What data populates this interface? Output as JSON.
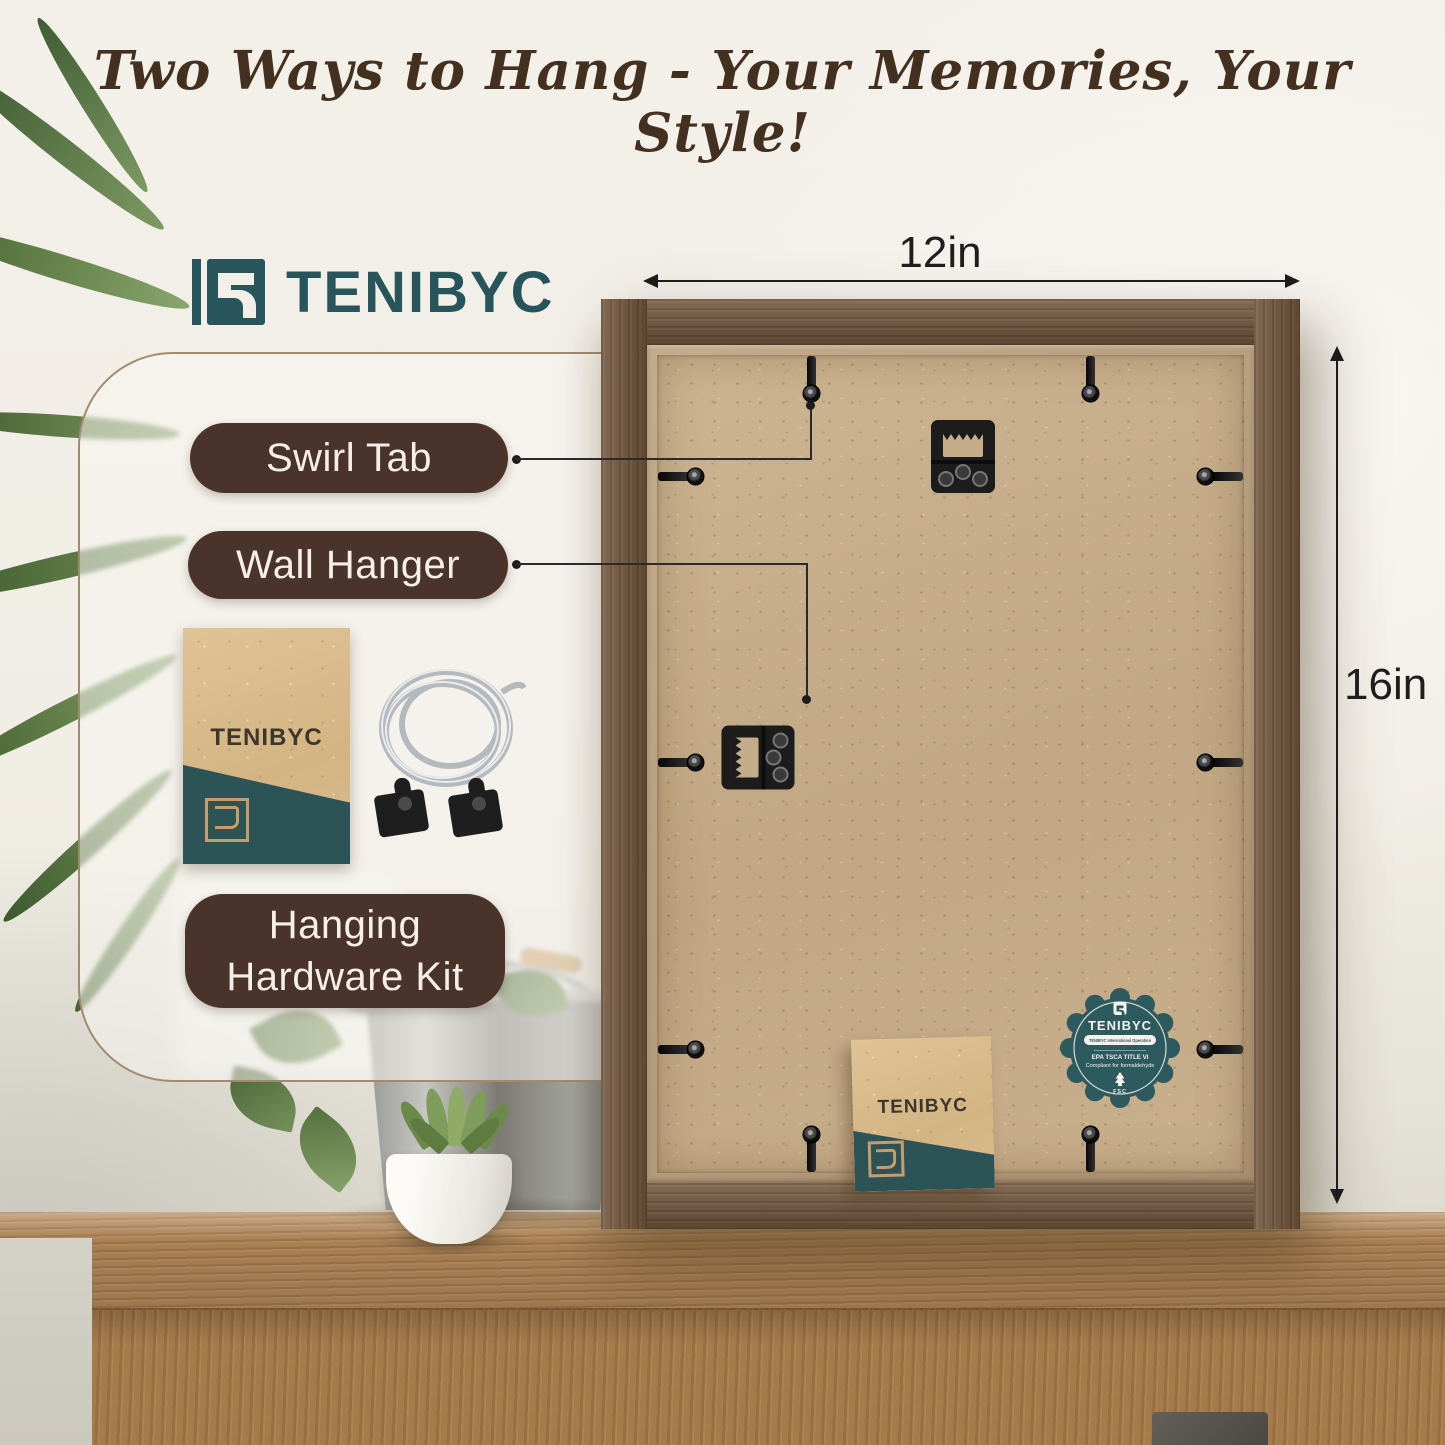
{
  "headline": "Two Ways to Hang - Your Memories, Your Style!",
  "brand": {
    "name": "TENIBYC"
  },
  "callouts": {
    "swirl_tab": "Swirl Tab",
    "wall_hanger": "Wall Hanger",
    "hardware_kit": [
      "Hanging",
      "Hardware Kit"
    ]
  },
  "dimensions": {
    "width": "12in",
    "height": "16in"
  },
  "badge": {
    "brand": "TENIBYC",
    "banner": "TENIBYC International Operation",
    "cert_line1": "EPA TSCA TITLE VI",
    "cert_line2": "Compliant for formaldehyde",
    "fsc": "FSC"
  },
  "colors": {
    "accent_teal": "#2d5a5e",
    "pill_brown": "#4a332a",
    "headline_brown": "#44301f",
    "frame_wood": "#70543a",
    "mdf_back": "#c9b08c"
  }
}
